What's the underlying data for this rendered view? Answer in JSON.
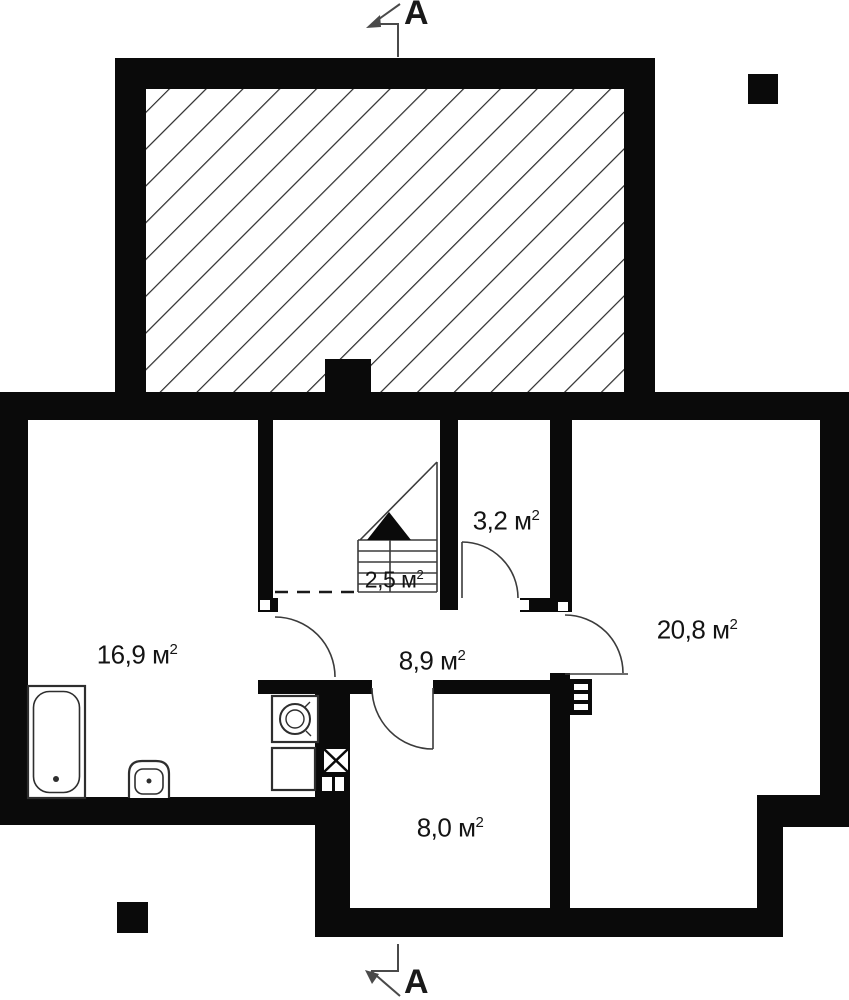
{
  "plan": {
    "section_label_top": "A",
    "section_label_bottom": "A",
    "unit": {
      "symbol": "м",
      "exponent": "2"
    },
    "rooms": [
      {
        "id": "bathroom",
        "area": "16,9"
      },
      {
        "id": "hall",
        "area": "8,9"
      },
      {
        "id": "stairs",
        "area": "2,5"
      },
      {
        "id": "wc",
        "area": "3,2"
      },
      {
        "id": "living",
        "area": "20,8"
      },
      {
        "id": "lower-room",
        "area": "8,0"
      }
    ]
  },
  "colors": {
    "wall": "#0a0a0a",
    "thin_line": "#3b3b3b",
    "hatch_line": "#2a2a2a",
    "background": "#ffffff"
  }
}
